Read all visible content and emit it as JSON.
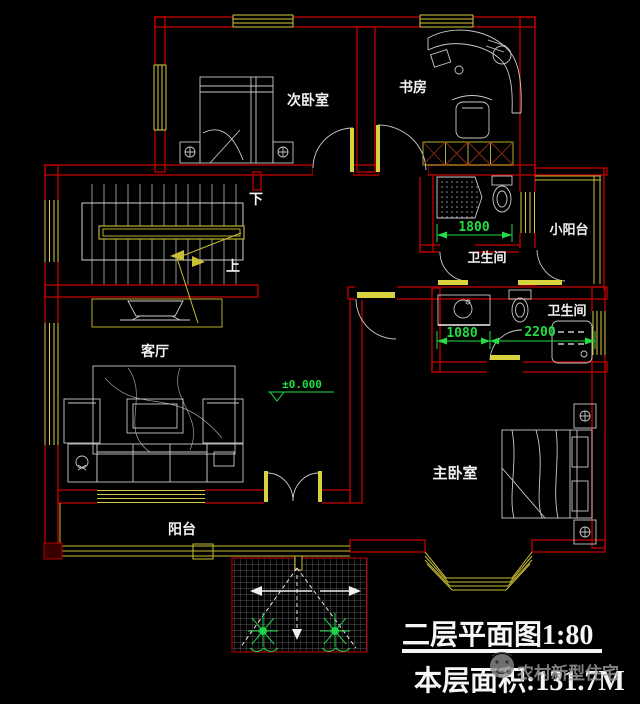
{
  "colors": {
    "background": "#000000",
    "wall_red": "#b40000",
    "window_yellow": "#d6ca3c",
    "dim_green": "#22dd44",
    "furniture_gray": "#c9c9c9",
    "label_white": "#f2f2f2",
    "watermark_gray": "#a0a0a0"
  },
  "rooms": {
    "secondary_bedroom": "次卧室",
    "study": "书房",
    "bathroom_upper": "卫生间",
    "small_balcony": "小阳台",
    "bathroom_lower": "卫生间",
    "living_room": "客厅",
    "master_bedroom": "主卧室",
    "balcony": "阳台"
  },
  "stairs": {
    "down": "下",
    "up": "上"
  },
  "dimensions": {
    "bathroom_upper_width": "1800",
    "bathroom_lower_left": "1080",
    "bathroom_lower_right": "2200"
  },
  "elevation_marker": "±0.000",
  "titleblock": {
    "plan_title": "二层平面图1:80",
    "floor_area": "本层面积:131.7M",
    "watermark": "农村新型住宅"
  }
}
